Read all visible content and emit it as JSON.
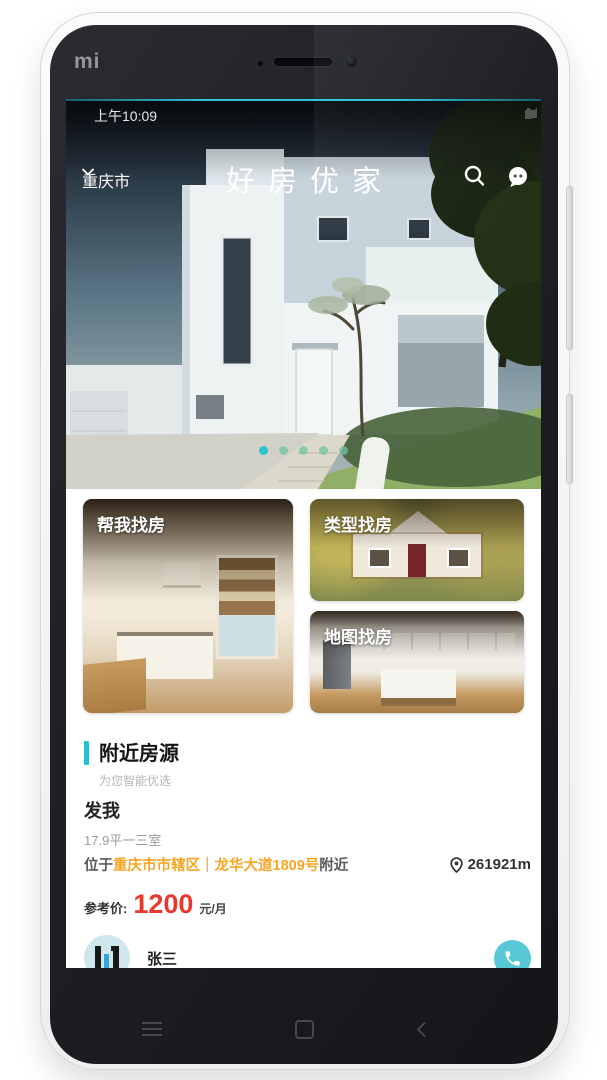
{
  "theme": {
    "accent": "#2cbcd0",
    "highlight": "#f5a623",
    "price_red": "#e8392f",
    "dot_active": "#29c3d6",
    "dot_inactive": "#6fc6a2"
  },
  "device": {
    "brand": "mi",
    "nav": {
      "menu": "menu",
      "home": "home",
      "back": "back"
    }
  },
  "status_bar": {
    "time": "上午10:09"
  },
  "header": {
    "city": "重庆市",
    "title": "好房优家"
  },
  "carousel": {
    "count": 5,
    "active": 0
  },
  "quick_actions": [
    {
      "label": "帮我找房"
    },
    {
      "label": "类型找房"
    },
    {
      "label": "地图找房"
    }
  ],
  "nearby": {
    "title": "附近房源",
    "subtitle": "为您智能优选"
  },
  "listing": {
    "name": "发我",
    "spec": "17.9平一三室",
    "loc_prefix": "位于",
    "loc_highlight": "重庆市市辖区｜龙华大道1809号",
    "loc_suffix": "附近",
    "distance": "261921m",
    "price_label": "参考价:",
    "price": "1200",
    "price_unit": "元/月",
    "agent": "张三"
  },
  "icons": {
    "search": "magnifier",
    "message": "chat-bubble",
    "city_chevron": "chevron-down",
    "distance_pin": "map-pin",
    "call": "phone-handset",
    "nav": [
      "hamburger-menu",
      "home-square",
      "back-chevron"
    ]
  }
}
